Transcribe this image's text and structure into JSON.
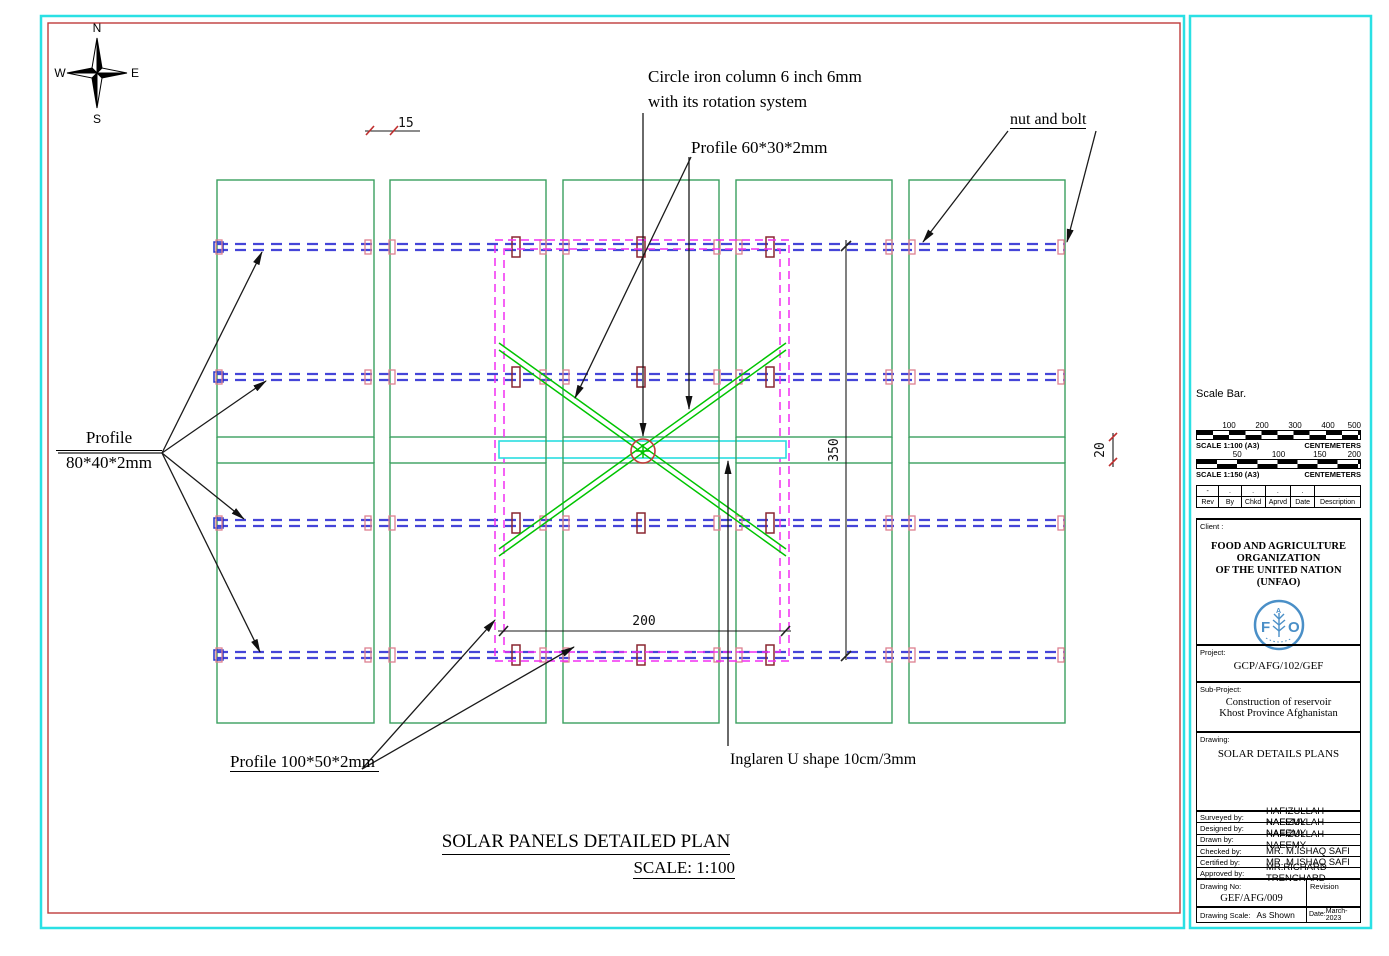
{
  "drawing": {
    "title": "SOLAR PANELS DETAILED PLAN",
    "scale_note": "SCALE: 1:100",
    "compass": {
      "n": "N",
      "e": "E",
      "s": "S",
      "w": "W"
    },
    "labels": {
      "circle_iron_1": "Circle iron column 6 inch 6mm",
      "circle_iron_2": "with its rotation system",
      "profile_60": "Profile 60*30*2mm",
      "nut_and_bolt": "nut and bolt",
      "profile_80_1": "Profile",
      "profile_80_2": "80*40*2mm",
      "profile_100": "Profile 100*50*2mm",
      "inglaren": "Inglaren U shape 10cm/3mm"
    },
    "dimensions": {
      "frame_height": "350",
      "frame_width": "200",
      "panel_gap": "15",
      "row_gap": "20"
    }
  },
  "titleblock": {
    "scale_bar_title": "Scale Bar.",
    "bar1": {
      "ticks": [
        "100",
        "200",
        "300",
        "400",
        "500"
      ],
      "scale_label": "SCALE 1:100 (A3)",
      "units": "CENTEMETERS"
    },
    "bar2": {
      "ticks": [
        "50",
        "100",
        "150",
        "200"
      ],
      "scale_label": "SCALE 1:150 (A3)",
      "units": "CENTEMETERS"
    },
    "revision_table": {
      "headers": [
        "Rev",
        "By",
        "Chkd",
        "Aprvd",
        "Date",
        "Description"
      ],
      "row": [
        "-",
        ".",
        ".",
        ".",
        ".",
        ""
      ]
    },
    "client_label": "Client :",
    "client_line1": "FOOD AND AGRICULTURE ORGANIZATION",
    "client_line2": "OF THE UNITED NATION (UNFAO)",
    "logo": {
      "f": "F",
      "a": "A",
      "o": "O"
    },
    "project_label": "Project:",
    "project_value": "GCP/AFG/102/GEF",
    "subproject_label": "Sub-Project:",
    "subproject_line1": "Construction of reservoir",
    "subproject_line2": "Khost Province Afghanistan",
    "drawing_label": "Drawing:",
    "drawing_value": "SOLAR DETAILS PLANS",
    "personnel": [
      {
        "label": "Surveyed  by:",
        "value": "HAFIZULLAH NAEEMY"
      },
      {
        "label": "Designed by:",
        "value": "HAFIZULLAH NAEEMY"
      },
      {
        "label": "Drawn by:",
        "value": "HAFIZULLAH NAEEMY"
      },
      {
        "label": "Checked by:",
        "value": "MR. M.ISHAQ SAFI"
      },
      {
        "label": "Certified by:",
        "value": "MR. M.ISHAQ SAFI"
      },
      {
        "label": "Approved by:",
        "value": "MR.RICHARD TRENCHARD"
      }
    ],
    "drawing_no_label": "Drawing No:",
    "drawing_no_value": "GEF/AFG/009",
    "revision_label": "Revision",
    "drawing_scale_label": "Drawing Scale:",
    "drawing_scale_value": "As Shown",
    "date_label": "Date:",
    "date_value": "March-2023"
  },
  "colors": {
    "sheet_border_cyan": "#2ae0e4",
    "sheet_border_red": "#bf3b3b",
    "panel_green": "#3aa05f",
    "rail_blue": "#4545d8",
    "frame_magenta": "#f22ef2",
    "brace_green": "#00c400",
    "band_cyan": "#2adde0",
    "column_red": "#c23a3a",
    "bolt_pink": "#dd8090",
    "bolt_dark_red": "#8a2630",
    "logo_blue": "#4a8fc7"
  }
}
